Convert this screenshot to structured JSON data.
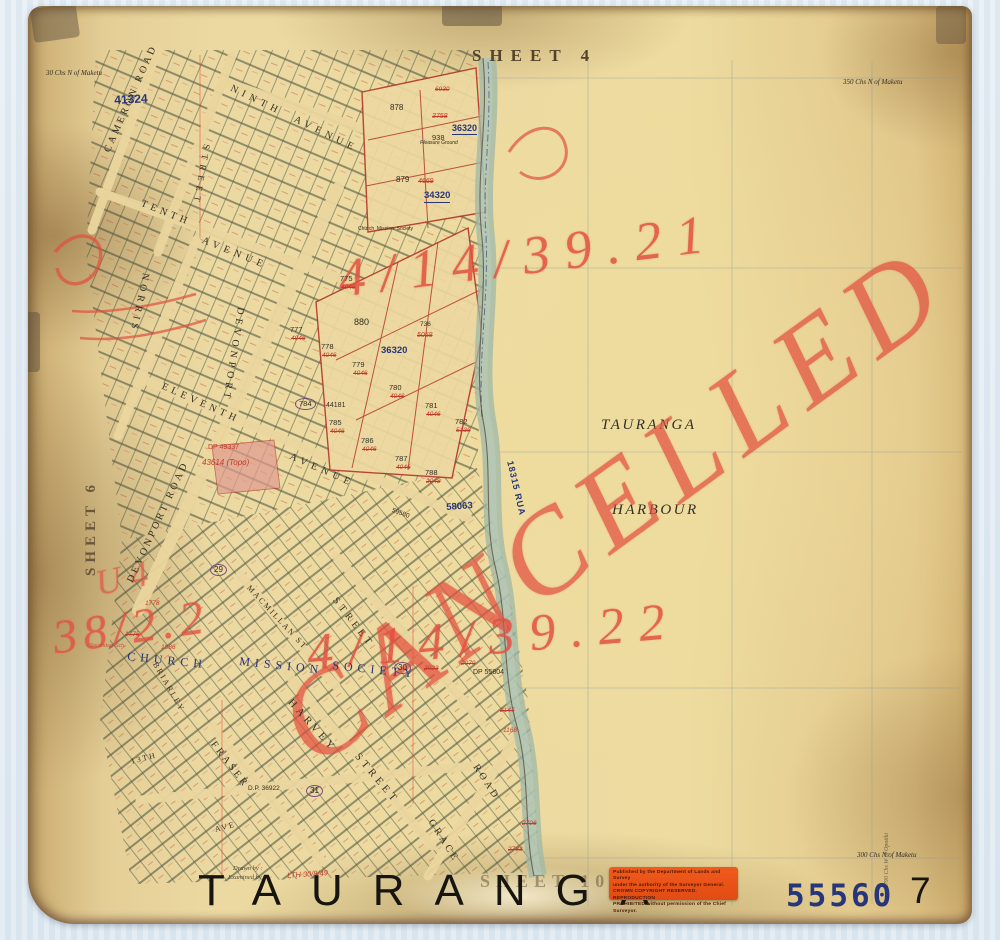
{
  "copyright": {
    "line1": "Published by the Department of Lands and Survey",
    "line2": "under the authority of the Surveyor General.",
    "line3": "CROWN COPYRIGHT RESERVED. REPRODUCTION",
    "line4": "PROHIBITED without permission of the Chief Surveyor."
  },
  "map_labels": [
    {
      "n": "sheet-4-label",
      "t": "SHEET 4",
      "x": 444,
      "y": 41,
      "s": 17,
      "c": "brown serif bold",
      "ls": 8
    },
    {
      "n": "sheet-6-label",
      "t": "SHEET 6",
      "x": 56,
      "y": 570,
      "s": 15,
      "r": -90,
      "c": "brown serif bold",
      "ls": 5,
      "o": 0.8
    },
    {
      "n": "sheet-10-label",
      "t": "SHEET 10",
      "x": 452,
      "y": 866,
      "s": 18,
      "c": "brown serif bold",
      "ls": 6,
      "o": 0.45
    },
    {
      "n": "harbour-name-line1",
      "t": "TAURANGA",
      "x": 573,
      "y": 412,
      "s": 15,
      "c": "ink serif ital",
      "ls": 2.5
    },
    {
      "n": "harbour-name-line2",
      "t": "HARBOUR",
      "x": 584,
      "y": 497,
      "s": 15,
      "c": "ink serif ital",
      "ls": 2.5
    },
    {
      "n": "bottom-title",
      "t": "TAURANGA",
      "x": 170,
      "y": 863,
      "s": 44,
      "c": "black sans",
      "ls": 30
    },
    {
      "n": "record-number-stamp",
      "t": "55560",
      "x": 758,
      "y": 875,
      "s": 31,
      "c": "navy mono bold",
      "ls": 3
    },
    {
      "n": "sheet-number",
      "t": "7",
      "x": 882,
      "y": 866,
      "s": 37,
      "c": "black sans"
    },
    {
      "n": "margin-note-top-left",
      "t": "30 Chs N of Maketu",
      "x": 18,
      "y": 64,
      "s": 7,
      "c": "ink serif ital"
    },
    {
      "n": "margin-note-top-right",
      "t": "350 Chs N of Maketu",
      "x": 815,
      "y": 73,
      "s": 7,
      "c": "ink serif ital"
    },
    {
      "n": "margin-note-bottom-right",
      "t": "300 Chs N of Maketu",
      "x": 829,
      "y": 846,
      "s": 7,
      "c": "ink serif ital"
    },
    {
      "n": "margin-note-right-edge",
      "t": "1790 Chs W of Opotiki",
      "x": 856,
      "y": 882,
      "s": 6,
      "r": -90,
      "c": "ink serif ital",
      "o": 0.65
    },
    {
      "n": "drawn-by-note",
      "t": "Drawn by :",
      "x": 205,
      "y": 860,
      "s": 6.5,
      "c": "ink serif ital",
      "o": 0.85
    },
    {
      "n": "examined-by-note",
      "t": "Examined by :",
      "x": 200,
      "y": 869,
      "s": 6.5,
      "c": "ink serif ital",
      "o": 0.85
    },
    {
      "n": "examined-signature",
      "t": "LTH 30/8/49",
      "x": 259,
      "y": 866,
      "s": 7.5,
      "r": -4,
      "c": "red ital"
    },
    {
      "n": "cancelled-annotation",
      "t": "CANCELLED",
      "x": 230,
      "y": 684,
      "s": 118,
      "r": -36,
      "c": "crayon ital",
      "ls": 14,
      "o": 0.72
    },
    {
      "n": "file-ref-top",
      "t": "4/14/39.21",
      "x": 307,
      "y": 246,
      "s": 54,
      "r": -7,
      "c": "crayon ital",
      "ls": 15,
      "o": 0.85
    },
    {
      "n": "file-ref-middle",
      "t": "4/14/39.22",
      "x": 277,
      "y": 622,
      "s": 52,
      "r": -5,
      "c": "crayon ital",
      "ls": 15,
      "o": 0.85
    },
    {
      "n": "file-ref-left",
      "t": "38/2.2",
      "x": 22,
      "y": 609,
      "s": 48,
      "r": -8,
      "c": "crayon ital",
      "ls": 6,
      "o": 0.8
    },
    {
      "n": "file-ref-left-upper",
      "t": "U 4",
      "x": 64,
      "y": 560,
      "s": 36,
      "r": -12,
      "c": "crayon ital",
      "o": 0.65
    },
    {
      "n": "street-label-cameron-road",
      "t": "CAMERON ROAD",
      "x": 75,
      "y": 144,
      "s": 10,
      "r": -66,
      "c": "ink serif",
      "ls": 3
    },
    {
      "n": "street-label-ninth-avenue",
      "t": "NINTH  AVENUE",
      "x": 205,
      "y": 78,
      "s": 10,
      "r": 26,
      "c": "ink serif",
      "ls": 5
    },
    {
      "n": "street-label-tenth",
      "t": "TENTH",
      "x": 115,
      "y": 193,
      "s": 10,
      "r": 22,
      "c": "ink serif",
      "ls": 4
    },
    {
      "n": "street-label-tenth-avenue",
      "t": "AVENUE",
      "x": 176,
      "y": 230,
      "s": 10,
      "r": 22,
      "c": "ink serif",
      "ls": 5
    },
    {
      "n": "street-label-eleventh",
      "t": "ELEVENTH",
      "x": 136,
      "y": 376,
      "s": 10,
      "r": 24,
      "c": "ink serif",
      "ls": 4
    },
    {
      "n": "street-label-eleventh-avenue",
      "t": "AVENUE",
      "x": 264,
      "y": 446,
      "s": 10,
      "r": 24,
      "c": "ink serif",
      "ls": 5
    },
    {
      "n": "street-label-norris",
      "t": "NORRIS",
      "x": 122,
      "y": 268,
      "s": 10,
      "r": 102,
      "c": "ink serif",
      "ls": 4
    },
    {
      "n": "street-label-street-north",
      "t": "STREET",
      "x": 183,
      "y": 139,
      "s": 9,
      "r": 100,
      "c": "ink serif",
      "ls": 5
    },
    {
      "n": "street-label-devonport-north",
      "t": "DEVONPORT",
      "x": 217,
      "y": 302,
      "s": 10,
      "r": 99,
      "c": "ink serif",
      "ls": 4
    },
    {
      "n": "street-label-devonport-road",
      "t": "DEVONPORT ROAD",
      "x": 98,
      "y": 574,
      "s": 10,
      "r": -65,
      "c": "ink serif",
      "ls": 3
    },
    {
      "n": "street-label-macmillan",
      "t": "MACMILLAN ST",
      "x": 223,
      "y": 578,
      "s": 8,
      "r": 47,
      "c": "ink serif",
      "ls": 2
    },
    {
      "n": "estate-label-church",
      "t": "CHURCH",
      "x": 100,
      "y": 644,
      "s": 12,
      "r": 6,
      "c": "navy serif",
      "ls": 5
    },
    {
      "n": "estate-label-mission",
      "t": "MISSION",
      "x": 212,
      "y": 649,
      "s": 12,
      "r": 6,
      "c": "navy serif",
      "ls": 5
    },
    {
      "n": "estate-label-society",
      "t": "SOCIETY",
      "x": 305,
      "y": 653,
      "s": 12,
      "r": 6,
      "c": "navy serif",
      "ls": 5
    },
    {
      "n": "street-label-briarley",
      "t": "BRIARLEY",
      "x": 130,
      "y": 655,
      "s": 8,
      "r": 60,
      "c": "ink serif",
      "ls": 2
    },
    {
      "n": "street-label-harvey",
      "t": "HARVEY",
      "x": 265,
      "y": 692,
      "s": 10.5,
      "r": 48,
      "c": "ink serif",
      "ls": 4
    },
    {
      "n": "street-label-harvey-street",
      "t": "STREET",
      "x": 332,
      "y": 746,
      "s": 10.5,
      "r": 50,
      "c": "ink serif",
      "ls": 4
    },
    {
      "n": "street-label-fraser",
      "t": "FRASER",
      "x": 188,
      "y": 734,
      "s": 10,
      "r": 52,
      "c": "ink serif",
      "ls": 3
    },
    {
      "n": "street-label-grace",
      "t": "GRACE",
      "x": 406,
      "y": 812,
      "s": 10,
      "r": 57,
      "c": "ink serif",
      "ls": 3
    },
    {
      "n": "street-label-grace-road",
      "t": "ROAD",
      "x": 451,
      "y": 757,
      "s": 10,
      "r": 57,
      "c": "ink serif",
      "ls": 3
    },
    {
      "n": "street-label-thirteenth",
      "t": "13TH",
      "x": 102,
      "y": 752,
      "s": 8,
      "r": -14,
      "c": "ink serif",
      "ls": 2
    },
    {
      "n": "street-label-ave",
      "t": "AVE",
      "x": 186,
      "y": 820,
      "s": 8,
      "r": -14,
      "c": "ink serif",
      "ls": 2
    },
    {
      "n": "street-label-street-mid",
      "t": "STREET",
      "x": 310,
      "y": 590,
      "s": 10,
      "r": 52,
      "c": "ink serif",
      "ls": 4
    },
    {
      "n": "plan-number-41324",
      "t": "41324",
      "x": 86,
      "y": 88,
      "s": 12,
      "r": -3,
      "c": "navy bold"
    },
    {
      "n": "plan-number-36320-north",
      "t": "36320",
      "x": 424,
      "y": 118,
      "s": 9,
      "c": "navy bold u"
    },
    {
      "n": "plan-number-34320",
      "t": "34320",
      "x": 396,
      "y": 185,
      "s": 9.5,
      "c": "navy bold u"
    },
    {
      "n": "plan-number-36320-mid",
      "t": "36320",
      "x": 353,
      "y": 340,
      "s": 9.5,
      "c": "navy bold"
    },
    {
      "n": "plan-number-58063",
      "t": "58063",
      "x": 418,
      "y": 497,
      "s": 9.5,
      "r": -4,
      "c": "navy bold"
    },
    {
      "n": "plan-number-18315-rua",
      "t": "18315 RUA",
      "x": 486,
      "y": 454,
      "s": 9,
      "r": 77,
      "c": "navy bold",
      "ls": 1
    },
    {
      "n": "plan-number-dp36922",
      "t": "D.P. 36922",
      "x": 220,
      "y": 780,
      "s": 6.5,
      "c": "ink"
    },
    {
      "n": "plan-number-dp55804",
      "t": "DP 55804",
      "x": 445,
      "y": 663,
      "s": 7,
      "c": "ink"
    },
    {
      "n": "plan-number-dp49337",
      "t": "DP 49337",
      "x": 180,
      "y": 438,
      "s": 7,
      "c": "red"
    },
    {
      "n": "plan-number-43614-topo",
      "t": "43614 (Topo)",
      "x": 174,
      "y": 453,
      "s": 8,
      "c": "red ital"
    },
    {
      "n": "plan-number-59580",
      "t": "59580",
      "x": 365,
      "y": 502,
      "s": 6.5,
      "r": 20,
      "c": "ink"
    },
    {
      "n": "lot-878",
      "t": "878",
      "x": 362,
      "y": 98,
      "s": 8,
      "c": "ink"
    },
    {
      "n": "red-3758",
      "t": "3758",
      "x": 404,
      "y": 107,
      "s": 7,
      "c": "red ital strike"
    },
    {
      "n": "lot-938",
      "t": "938",
      "x": 404,
      "y": 128,
      "s": 7.5,
      "c": "ink"
    },
    {
      "n": "note-pleasure-ground",
      "t": "Pleasure Ground",
      "x": 392,
      "y": 135,
      "s": 5,
      "c": "ink ital"
    },
    {
      "n": "note-church-mission",
      "t": "Church  Mission  Society",
      "x": 330,
      "y": 221,
      "s": 5,
      "c": "ink"
    },
    {
      "n": "lot-879",
      "t": "879",
      "x": 368,
      "y": 170,
      "s": 8,
      "c": "ink"
    },
    {
      "n": "red-4669",
      "t": "4669",
      "x": 390,
      "y": 172,
      "s": 7,
      "c": "red ital strike"
    },
    {
      "n": "red-6930",
      "t": "6930",
      "x": 407,
      "y": 81,
      "s": 6.5,
      "c": "red ital strike"
    },
    {
      "n": "lot-880",
      "t": "880",
      "x": 326,
      "y": 312,
      "s": 9,
      "c": "ink"
    },
    {
      "n": "lot-775",
      "t": "775",
      "x": 312,
      "y": 269,
      "s": 7.5,
      "c": "ink"
    },
    {
      "n": "red-4046-775",
      "t": "4046",
      "x": 313,
      "y": 279,
      "s": 6.5,
      "c": "red ital strike"
    },
    {
      "n": "lot-736",
      "t": "736",
      "x": 392,
      "y": 316,
      "s": 6.5,
      "c": "ink"
    },
    {
      "n": "red-5058",
      "t": "5058",
      "x": 389,
      "y": 326,
      "s": 7,
      "c": "red ital strike"
    },
    {
      "n": "lot-777",
      "t": "777",
      "x": 262,
      "y": 320,
      "s": 7.5,
      "c": "ink"
    },
    {
      "n": "red-4046-777",
      "t": "4046",
      "x": 263,
      "y": 330,
      "s": 6.5,
      "c": "red ital strike"
    },
    {
      "n": "lot-778",
      "t": "778",
      "x": 293,
      "y": 337,
      "s": 7.5,
      "c": "ink"
    },
    {
      "n": "red-4046-778",
      "t": "4046",
      "x": 294,
      "y": 347,
      "s": 6.5,
      "c": "red ital strike"
    },
    {
      "n": "lot-779",
      "t": "779",
      "x": 324,
      "y": 355,
      "s": 7.5,
      "c": "ink"
    },
    {
      "n": "red-4046-779",
      "t": "4046",
      "x": 325,
      "y": 365,
      "s": 6.5,
      "c": "red ital strike"
    },
    {
      "n": "lot-780",
      "t": "780",
      "x": 361,
      "y": 378,
      "s": 7.5,
      "c": "ink"
    },
    {
      "n": "red-4046-780",
      "t": "4046",
      "x": 362,
      "y": 388,
      "s": 6.5,
      "c": "red ital strike"
    },
    {
      "n": "lot-781",
      "t": "781",
      "x": 397,
      "y": 396,
      "s": 7.5,
      "c": "ink"
    },
    {
      "n": "red-4046-781",
      "t": "4046",
      "x": 398,
      "y": 406,
      "s": 6.5,
      "c": "red ital strike"
    },
    {
      "n": "lot-782",
      "t": "782",
      "x": 427,
      "y": 412,
      "s": 7.5,
      "c": "ink"
    },
    {
      "n": "red-5136",
      "t": "5136",
      "x": 428,
      "y": 422,
      "s": 6.5,
      "c": "red ital strike"
    },
    {
      "n": "lot-784",
      "t": "784",
      "x": 267,
      "y": 392,
      "s": 7.5,
      "c": "ink circ"
    },
    {
      "n": "lot-44181",
      "t": "44181",
      "x": 298,
      "y": 396,
      "s": 7,
      "c": "ink"
    },
    {
      "n": "lot-785",
      "t": "785",
      "x": 301,
      "y": 413,
      "s": 7.5,
      "c": "ink"
    },
    {
      "n": "red-4046-785",
      "t": "4046",
      "x": 302,
      "y": 423,
      "s": 6.5,
      "c": "red ital strike"
    },
    {
      "n": "lot-786",
      "t": "786",
      "x": 333,
      "y": 431,
      "s": 7.5,
      "c": "ink"
    },
    {
      "n": "red-4046-786",
      "t": "4046",
      "x": 334,
      "y": 441,
      "s": 6.5,
      "c": "red ital strike"
    },
    {
      "n": "lot-787",
      "t": "787",
      "x": 367,
      "y": 449,
      "s": 7.5,
      "c": "ink"
    },
    {
      "n": "red-4046-787",
      "t": "4046",
      "x": 368,
      "y": 459,
      "s": 6.5,
      "c": "red ital strike"
    },
    {
      "n": "lot-788",
      "t": "788",
      "x": 397,
      "y": 463,
      "s": 7.5,
      "c": "ink"
    },
    {
      "n": "red-2048",
      "t": "2048",
      "x": 398,
      "y": 473,
      "s": 6.5,
      "c": "red ital strike"
    },
    {
      "n": "circled-29",
      "t": "29",
      "x": 182,
      "y": 558,
      "s": 8,
      "c": "ink circ"
    },
    {
      "n": "circled-30",
      "t": "30",
      "x": 366,
      "y": 656,
      "s": 8,
      "c": "ink circ"
    },
    {
      "n": "circled-31",
      "t": "31",
      "x": 278,
      "y": 779,
      "s": 8,
      "c": "ink circ"
    },
    {
      "n": "red-1778",
      "t": "1778",
      "x": 117,
      "y": 595,
      "s": 6.5,
      "c": "red ital"
    },
    {
      "n": "red-1775",
      "t": "1775",
      "x": 97,
      "y": 626,
      "s": 6.5,
      "c": "red ital strike"
    },
    {
      "n": "red-1886",
      "t": "1886",
      "x": 133,
      "y": 639,
      "s": 6.5,
      "c": "red ital"
    },
    {
      "n": "red-2023",
      "t": "2023",
      "x": 396,
      "y": 660,
      "s": 6.5,
      "c": "red ital strike"
    },
    {
      "n": "red-2079",
      "t": "2079",
      "x": 433,
      "y": 655,
      "s": 6.5,
      "c": "red ital strike"
    },
    {
      "n": "red-2147",
      "t": "2147",
      "x": 472,
      "y": 702,
      "s": 6.5,
      "c": "red ital strike"
    },
    {
      "n": "red-1168",
      "t": "1168",
      "x": 475,
      "y": 722,
      "s": 6.5,
      "c": "red ital"
    },
    {
      "n": "red-2706",
      "t": "2706",
      "x": 494,
      "y": 815,
      "s": 6.5,
      "c": "red ital strike"
    },
    {
      "n": "red-2783",
      "t": "2783",
      "x": 480,
      "y": 841,
      "s": 6.5,
      "c": "red ital strike"
    },
    {
      "n": "note-secondary-sch",
      "t": "Secondary Sch.",
      "x": 62,
      "y": 638,
      "s": 5,
      "c": "red ital",
      "o": 0.8
    }
  ]
}
